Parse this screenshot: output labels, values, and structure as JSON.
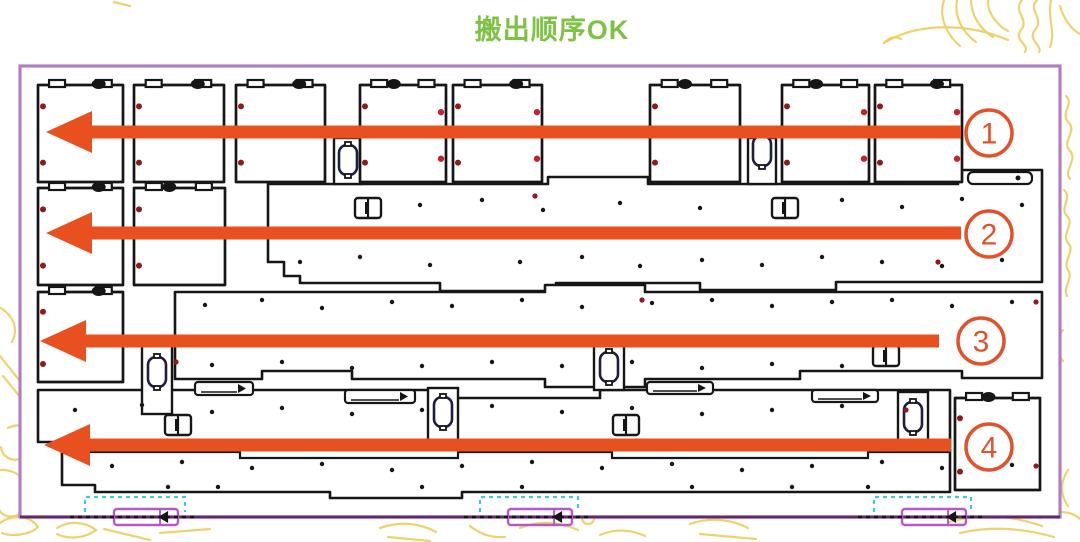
{
  "title": {
    "text": "搬出顺序OK",
    "color": "#7dc242"
  },
  "colors": {
    "arrow": "#e8511f",
    "circle": "#e2522a",
    "ink": "#161616",
    "oval_stroke": "#1d1d45",
    "frame": "#b07ec2",
    "frame_bottom": "#63276f",
    "cyan": "#42c9d9",
    "marker_purple": "#b558c8",
    "dot_dark_red": "#8e1a1c",
    "dot_bright_red": "#c4232b",
    "decor_yellow": "#eed063",
    "panel_bg": "#ffffff"
  },
  "arrows": [
    {
      "label": "1",
      "y": 132,
      "tip_x": 46,
      "tail_x": 961,
      "circle_cx": 989,
      "circle_cy": 133
    },
    {
      "label": "2",
      "y": 233,
      "tip_x": 46,
      "tail_x": 961,
      "circle_cx": 989,
      "circle_cy": 234
    },
    {
      "label": "3",
      "y": 341,
      "tip_x": 40,
      "tail_x": 939,
      "circle_cx": 981,
      "circle_cy": 341
    },
    {
      "label": "4",
      "y": 445,
      "tip_x": 44,
      "tail_x": 951,
      "circle_cx": 989,
      "circle_cy": 447
    }
  ],
  "panel": {
    "frame": {
      "x": 20,
      "y": 66,
      "w": 1040,
      "h": 451
    },
    "squares": [
      [
        38,
        85,
        85,
        97,
        0,
        0.62
      ],
      [
        134,
        85,
        90,
        97,
        0,
        0.62
      ],
      [
        236,
        85,
        89,
        97,
        0,
        0.62
      ],
      [
        360,
        85,
        86,
        97,
        1,
        0.3
      ],
      [
        453,
        85,
        89,
        97,
        1,
        0.62
      ],
      [
        650,
        85,
        90,
        97,
        0,
        0.3
      ],
      [
        782,
        85,
        87,
        97,
        1,
        0.3
      ],
      [
        875,
        85,
        87,
        97,
        1,
        0.62
      ],
      [
        38,
        188,
        85,
        97,
        0,
        0.62
      ],
      [
        134,
        188,
        91,
        97,
        0,
        0.3
      ],
      [
        38,
        292,
        85,
        90,
        0,
        0.62
      ],
      [
        955,
        398,
        85,
        92,
        0,
        0.3
      ]
    ],
    "slabs": [
      "M268 184 L548 184 L548 177 L648 177 L648 184 L958 184 L958 170 L1042 170 L1042 282 L836 282 L836 290 L700 290 L700 283 L556 283 L556 291 L440 291 L440 283 L300 283 L300 276 L284 276 L284 262 L268 262 Z",
      "M175 292 L545 292 L545 285 L645 285 L645 292 L1042 292 L1042 378 L962 378 L962 371 L800 371 L800 379 L645 379 L645 387 L545 387 L545 379 L352 379 L352 371 L262 371 L262 379 L175 379 Z",
      "M38 390 L440 390 L440 398 L600 398 L600 390 L950 390 L950 492 L462 492 L462 498 L330 498 L330 492 L95 492 L95 485 L62 485 L62 442 L38 442 Z"
    ],
    "slab_lines": [
      "M62 452 L240 452 L240 458 L458 458 L458 452 L612 452 L612 458 L868 458 L868 452 L950 452"
    ],
    "bars": [
      [
        334,
        138,
        28,
        46
      ],
      [
        748,
        138,
        28,
        46
      ],
      [
        142,
        340,
        30,
        74
      ],
      [
        428,
        388,
        30,
        52
      ],
      [
        594,
        346,
        30,
        44
      ],
      [
        898,
        392,
        30,
        52
      ]
    ],
    "ovals": [
      [
        348,
        160
      ],
      [
        762,
        151
      ],
      [
        157,
        372
      ],
      [
        443,
        412
      ],
      [
        609,
        367
      ],
      [
        913,
        417
      ]
    ],
    "slots": [
      [
        368,
        208
      ],
      [
        785,
        208
      ],
      [
        886,
        356
      ],
      [
        178,
        425
      ],
      [
        626,
        425
      ]
    ],
    "wide_slots": [
      [
        968,
        172,
        64,
        12
      ]
    ],
    "thin_pieces": [
      [
        195,
        382,
        58,
        13
      ],
      [
        345,
        390,
        70,
        13
      ],
      [
        647,
        382,
        66,
        12
      ],
      [
        812,
        390,
        66,
        12
      ]
    ],
    "red_dots": [
      [
        535,
        196
      ],
      [
        938,
        262
      ],
      [
        642,
        300
      ],
      [
        1036,
        302
      ],
      [
        176,
        362
      ],
      [
        906,
        410
      ],
      [
        1036,
        466
      ]
    ],
    "black_dots": [
      [
        420,
        205
      ],
      [
        482,
        200
      ],
      [
        543,
        210
      ],
      [
        620,
        203
      ],
      [
        700,
        208
      ],
      [
        842,
        200
      ],
      [
        902,
        207
      ],
      [
        962,
        199
      ],
      [
        1022,
        205
      ],
      [
        300,
        262
      ],
      [
        360,
        257
      ],
      [
        430,
        265
      ],
      [
        520,
        262
      ],
      [
        582,
        257
      ],
      [
        640,
        266
      ],
      [
        702,
        260
      ],
      [
        762,
        265
      ],
      [
        822,
        257
      ],
      [
        882,
        262
      ],
      [
        942,
        266
      ],
      [
        1002,
        260
      ],
      [
        205,
        305
      ],
      [
        262,
        300
      ],
      [
        322,
        308
      ],
      [
        392,
        302
      ],
      [
        452,
        306
      ],
      [
        522,
        300
      ],
      [
        582,
        307
      ],
      [
        652,
        303
      ],
      [
        712,
        300
      ],
      [
        772,
        306
      ],
      [
        832,
        302
      ],
      [
        892,
        300
      ],
      [
        952,
        306
      ],
      [
        1012,
        302
      ],
      [
        212,
        365
      ],
      [
        282,
        362
      ],
      [
        352,
        368
      ],
      [
        422,
        366
      ],
      [
        492,
        362
      ],
      [
        562,
        366
      ],
      [
        632,
        362
      ],
      [
        702,
        368
      ],
      [
        772,
        364
      ],
      [
        842,
        366
      ],
      [
        75,
        410
      ],
      [
        142,
        405
      ],
      [
        212,
        412
      ],
      [
        282,
        408
      ],
      [
        352,
        414
      ],
      [
        422,
        410
      ],
      [
        492,
        406
      ],
      [
        562,
        412
      ],
      [
        632,
        408
      ],
      [
        702,
        414
      ],
      [
        772,
        410
      ],
      [
        842,
        406
      ],
      [
        112,
        466
      ],
      [
        182,
        462
      ],
      [
        252,
        468
      ],
      [
        322,
        464
      ],
      [
        392,
        470
      ],
      [
        462,
        466
      ],
      [
        532,
        462
      ],
      [
        602,
        468
      ],
      [
        672,
        464
      ],
      [
        742,
        470
      ],
      [
        812,
        466
      ],
      [
        882,
        462
      ],
      [
        942,
        468
      ],
      [
        1012,
        465
      ],
      [
        168,
        487
      ],
      [
        218,
        487
      ],
      [
        422,
        487
      ],
      [
        522,
        487
      ],
      [
        692,
        487
      ],
      [
        792,
        487
      ],
      [
        868,
        487
      ]
    ],
    "bottom_markers": [
      {
        "cyan": [
          85,
          497,
          100,
          15
        ],
        "purple": [
          114,
          509,
          64,
          16
        ]
      },
      {
        "cyan": [
          480,
          497,
          98,
          15
        ],
        "purple": [
          508,
          509,
          64,
          16
        ]
      },
      {
        "cyan": [
          874,
          497,
          97,
          15
        ],
        "purple": [
          902,
          509,
          64,
          16
        ]
      }
    ]
  },
  "decor": {
    "paths": [
      "M944 0 C938 18 948 36 960 46",
      "M957 0 C954 16 962 32 976 42",
      "M971 0 C971 15 980 29 993 37",
      "M988 0 C987 13 997 25 1008 31",
      "M1022 0 C1012 12 1030 18 1021 30 C1013 41 1030 44 1025 52",
      "M1037 0 C1027 10 1045 18 1035 30 C1027 40 1043 46 1039 52",
      "M1051 0 C1047 17 1056 33 1050 47",
      "M1060 6 C1064 20 1072 30 1080 34",
      "M884 43 C918 22 968 23 1008 40",
      "M884 43 C889 37 896 36 901 39",
      "M1066 96 C1075 104 1059 113 1069 123 C1077 132 1061 142 1070 151 C1078 160 1063 170 1070 179",
      "M1064 190 C1073 198 1059 208 1067 216 C1075 224 1061 234 1068 243 C1076 251 1062 261 1068 270 C1074 278 1062 288 1067 296",
      "M1063 330 C1055 340 1055 352 1063 361",
      "M1057 428 C1049 441 1049 456 1059 467",
      "M1068 470 C1060 482 1060 495 1068 506",
      "M1 308 C13 316 19 328 12 342",
      "M0 356 L27 390",
      "M3 376 L29 408",
      "M8 428 C27 419 40 435 30 451 C20 465 3 461 1 447",
      "M0 470 C19 469 33 484 29 501 C25 517 6 521 0 511",
      "M0 523 C12 514 30 515 38 527 C30 535 12 537 2 533",
      "M57 528 C70 520 86 522 96 530 C86 538 68 540 57 534",
      "M104 529 L150 540",
      "M160 533 L210 529",
      "M380 528 C400 521 420 523 436 532",
      "M388 537 L430 541",
      "M470 526 C480 534 492 538 505 537",
      "M520 528 C540 520 560 522 578 530",
      "M588 524 a6 6 0 1 1 0.2 0",
      "M600 535 C616 528 632 530 645 536",
      "M690 524 C710 517 731 519 748 528",
      "M700 534 L756 539",
      "M950 522 C980 513 1010 515 1042 526",
      "M960 533 C990 526 1022 528 1054 537",
      "M1040 518 C1056 509 1072 511 1080 519",
      "M114 2 L130 6"
    ]
  }
}
